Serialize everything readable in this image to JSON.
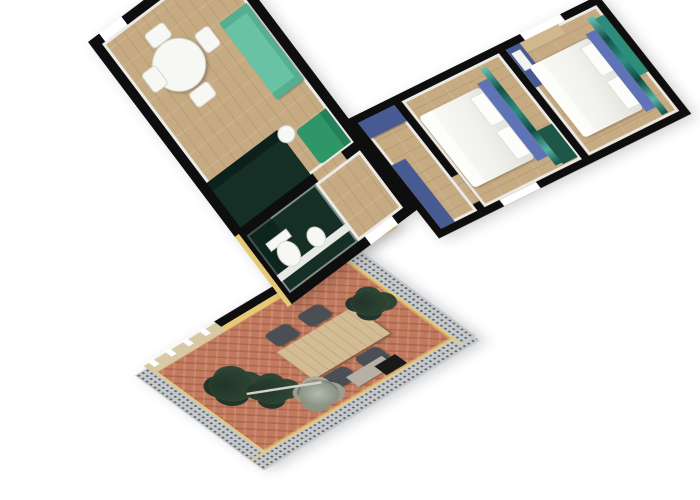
{
  "scene": {
    "type": "3d-floorplan-top-down-render",
    "background": "#ffffff",
    "rooms": [
      {
        "name": "living-dining-room",
        "floor": "light-wood",
        "furniture": [
          "round-white-dining-table",
          "white-chairs-x4",
          "teal-sofa",
          "green-armchair",
          "white-side-table",
          "dark-green-kitchenette"
        ]
      },
      {
        "name": "bathroom",
        "floor": "dark-green",
        "furniture": [
          "toilet",
          "bidet",
          "white-half-wall",
          "dark-shower-zone"
        ]
      },
      {
        "name": "hallway",
        "floor": "light-wood",
        "furniture": [
          "blue-wardrobe",
          "blue-wardrobe"
        ]
      },
      {
        "name": "bedroom-1",
        "floor": "light-wood",
        "window": "lower-wall",
        "furniture": [
          "double-bed-white-linen",
          "pillows-x2",
          "blue-headboard",
          "teal-wall-mural",
          "green-wardrobe"
        ]
      },
      {
        "name": "bedroom-2",
        "floor": "light-wood",
        "window": "upper-wall",
        "furniture": [
          "double-bed-white-linen",
          "pillows-x2",
          "blue-headboard",
          "teal-wall-mural",
          "teal-wardrobe",
          "blue-wardrobe-with-towel",
          "wood-desk"
        ]
      },
      {
        "name": "terrace",
        "floor": "terracotta-herringbone",
        "walls": "gray-stone-with-yellow-inner-face",
        "furniture": [
          "wood-dining-table",
          "dark-chairs-x4",
          "potted-plant-x3",
          "palm-plant",
          "gray-console",
          "black-grill",
          "umbrella-pole",
          "tan-wall-with-white-posts"
        ]
      }
    ],
    "colors": {
      "bg": "#ffffff",
      "wall": "#0e0e0e",
      "wall_face": "#eceae6",
      "wood": "#c6aa82",
      "terracotta": "#c17a5e",
      "sofa_teal": "#69c2a3",
      "sofa_teal_dark": "#54ae8f",
      "armchair_green": "#2f9668",
      "armchair_dark": "#25805a",
      "dark_green": "#152f27",
      "kitchen_top": "#0c211b",
      "cabinet_blue": "#475a92",
      "headboard_blue": "#5e74b6",
      "mural_teal": "#2f8d83",
      "mural_dark": "#14524b",
      "mural_light": "#6cc3b5",
      "yellow_wall": "#e6c974",
      "stone_gray": "#c6c9cb",
      "stone_dot": "#5a5f64",
      "desk_tan": "#cfb78e",
      "tan_face": "#d8c8a6",
      "chair_dark": "#4a4f55",
      "plant_green": "#2c4434",
      "plant_dark": "#223528",
      "palm_gray": "#8a9486",
      "table_wood": "#d3bc93",
      "towel_white": "#f2f2ef",
      "wardrobe_teal": "#2c8d7c",
      "wardrobe_dark_green": "#1e5748",
      "fixture_white": "#f7f7f4",
      "console_gray": "#b6b0a5",
      "grill_black": "#181818"
    }
  }
}
